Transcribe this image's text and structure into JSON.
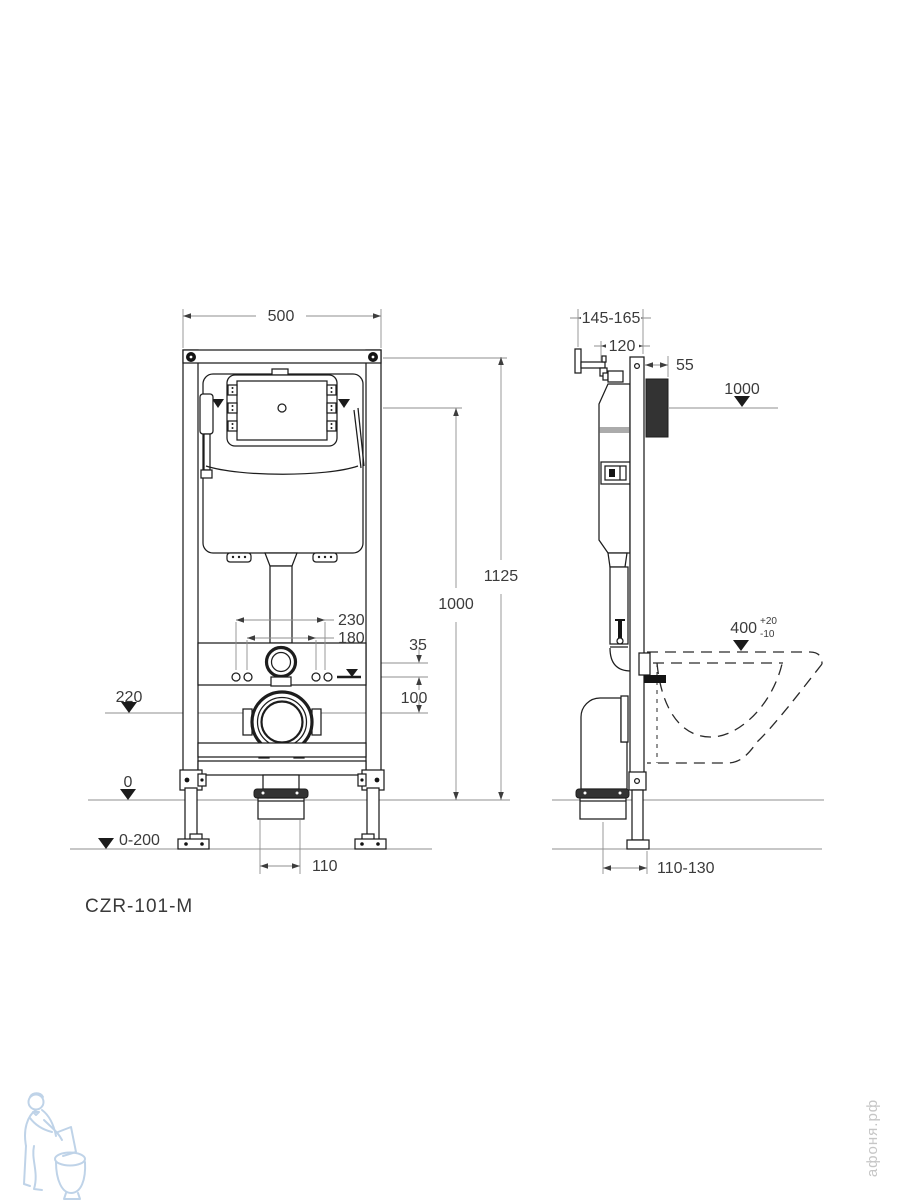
{
  "model_label": "CZR-101-M",
  "watermark_site": "афоня.рф",
  "front": {
    "width": "500",
    "overall_height": "1125",
    "button_height": "1000",
    "rod_spacing_outer": "230",
    "rod_spacing_inner": "180",
    "water_to_flush": "35",
    "water_to_drain": "100",
    "drain_level": "220",
    "floor_level": "0",
    "leg_adjustment": "0-200",
    "outlet_width": "110"
  },
  "side": {
    "depth": "145-165",
    "frame_depth": "120",
    "plate_depth": "55",
    "panel_height": "1000",
    "bowl_rim_height": "400",
    "bowl_tol_up": "+20",
    "bowl_tol_down": "-10",
    "outlet_distance": "110-130"
  }
}
